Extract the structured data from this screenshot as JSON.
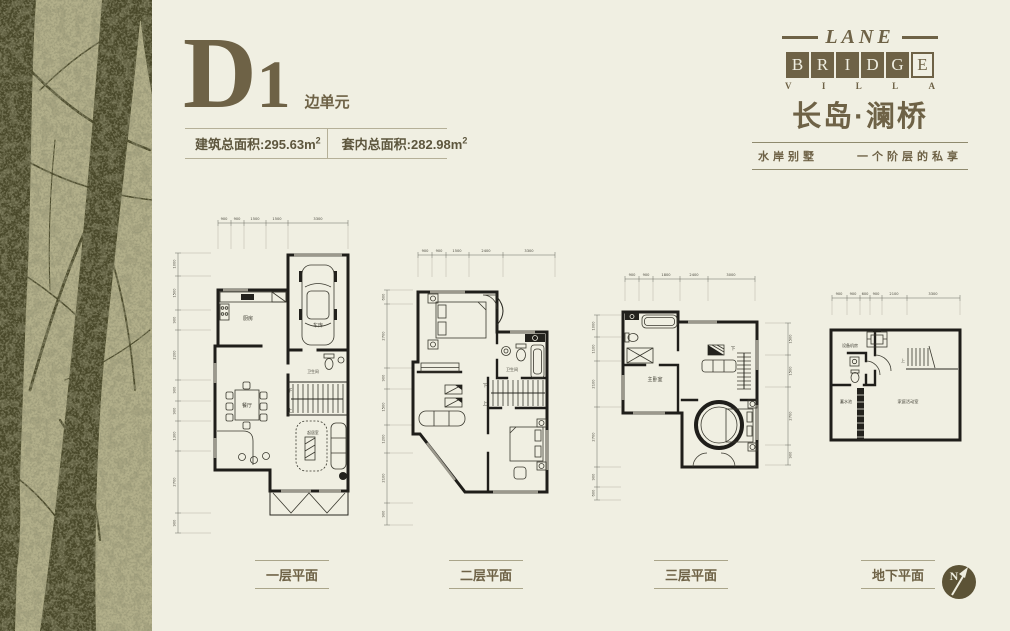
{
  "colors": {
    "page_bg": "#f0efe2",
    "brand_olive": "#6e6246",
    "wall_ink": "#1f1e1a",
    "sidebar_bg": "#b2af8a",
    "sidebar_tree": "#4a492b"
  },
  "header": {
    "unit_d": "D",
    "unit_1": "1",
    "unit_type": "边单元",
    "area_build": {
      "label": "建筑总面积:295.63m",
      "sup": "2"
    },
    "area_inner": {
      "label": "套内总面积:282.98m",
      "sup": "2"
    }
  },
  "logo": {
    "lane": "LANE",
    "bridge": [
      "B",
      "R",
      "I",
      "D",
      "G",
      "E"
    ],
    "villa": [
      "V",
      "I",
      "L",
      "L",
      "A"
    ],
    "cn_name": "长岛·澜桥",
    "tagline_left": "水岸别墅",
    "tagline_right": "一个阶层的私享"
  },
  "plans": [
    {
      "title": "一层平面",
      "rooms": {
        "kitchen": "厨房",
        "garage": "车库",
        "bath": "卫生间",
        "dining": "餐厅",
        "living": "起居室"
      },
      "stair_down": "下",
      "stair_up": "上",
      "dims_top": [
        "900",
        "900",
        "1500",
        "1500",
        "3300"
      ],
      "dims_left": [
        "1000",
        "1500",
        "900",
        "2200",
        "900",
        "900",
        "1300",
        "2700",
        "900"
      ]
    },
    {
      "title": "二层平面",
      "rooms": {
        "bath": "卫生间"
      },
      "stair_down": "下",
      "stair_up": "上",
      "dims_top": [
        "900",
        "900",
        "1500",
        "2400",
        "3300"
      ],
      "dims_left": [
        "600",
        "2700",
        "900",
        "1500",
        "1200",
        "2100",
        "900"
      ]
    },
    {
      "title": "三层平面",
      "rooms": {
        "master": "主卧室"
      },
      "stair_down": "下",
      "dims_top": [
        "900",
        "900",
        "1800",
        "2400",
        "3000"
      ],
      "dims_left": [
        "1000",
        "1100",
        "2100",
        "2700",
        "900",
        "600"
      ],
      "dims_right": [
        "1500",
        "1500",
        "2700",
        "900"
      ]
    },
    {
      "title": "地下平面",
      "rooms": {
        "equipment": "设备机房",
        "cistern": "蓄水池",
        "family": "家庭活动室"
      },
      "stair_up": "上",
      "dims_top": [
        "900",
        "900",
        "600",
        "900",
        "2100",
        "3300"
      ]
    }
  ],
  "compass": {
    "n": "N"
  }
}
